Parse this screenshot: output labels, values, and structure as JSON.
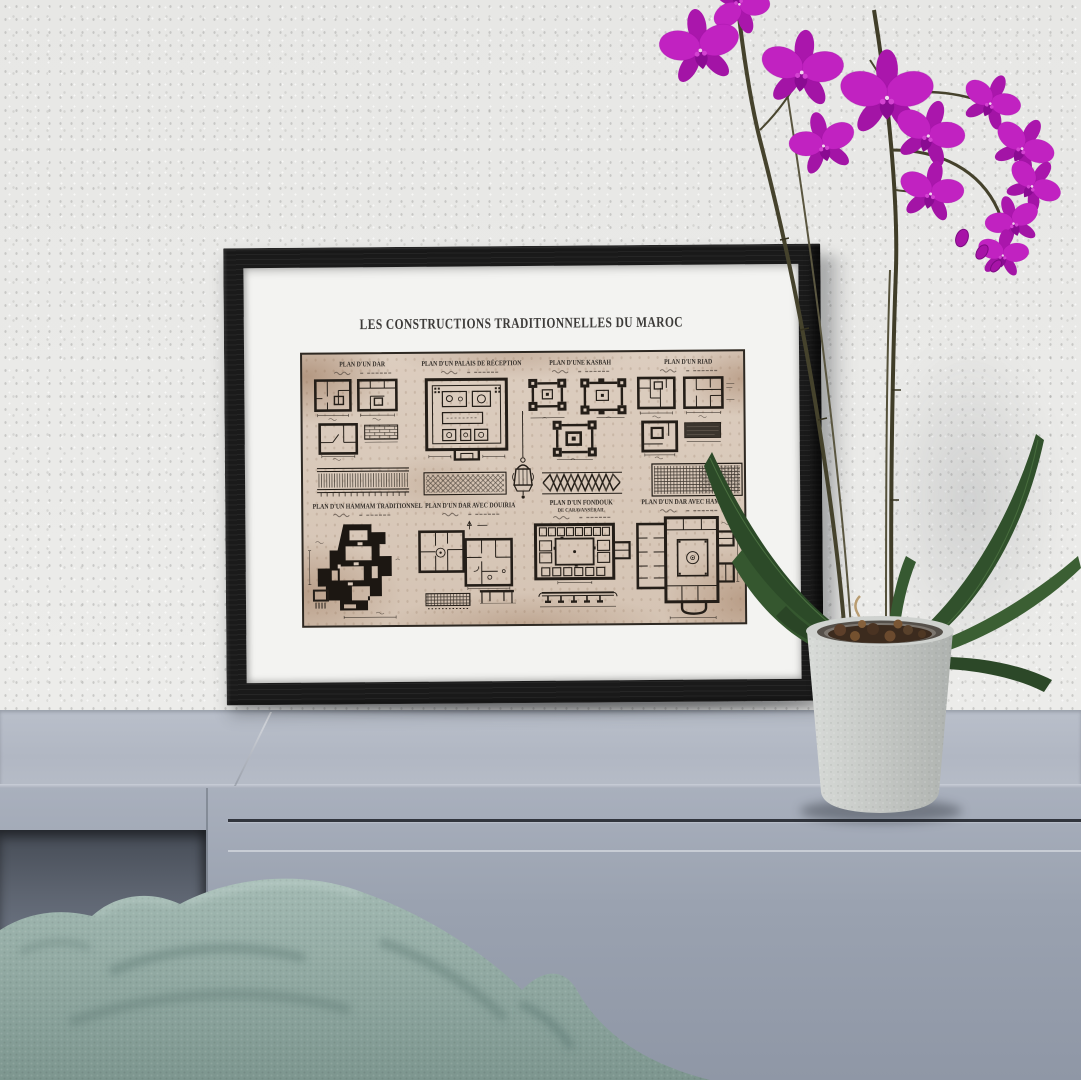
{
  "poster": {
    "title": "LES CONSTRUCTIONS TRADITIONNELLES DU MAROC",
    "plans": [
      {
        "title": "PLAN D'UN DAR"
      },
      {
        "title": "PLAN D'UN PALAIS DE RÉCEPTION"
      },
      {
        "title": "PLAN D'UNE KASBAH"
      },
      {
        "title": "PLAN D'UN RIAD"
      },
      {
        "title": "PLAN D'UN HAMMAM TRADITIONNEL"
      },
      {
        "title": "PLAN D'UN DAR AVEC DOUIRIA"
      },
      {
        "title": "PLAN D'UN FONDOUK",
        "subtitle": "DE CARAVANSÉRAIL"
      },
      {
        "title": "PLAN D'UN DAR AVEC HAMMAM"
      }
    ]
  },
  "scene": {
    "colors": {
      "wall": "#e9e9e7",
      "frame": "#1a1a1a",
      "mat": "#f3f3f1",
      "poster_paper": "#d9c9ba",
      "stain_brown": "#b08d71",
      "ink": "#241e18",
      "sideboard_top": "#b4bac6",
      "sideboard_front": "#9da5b2",
      "recess_shadow": "#565d68",
      "cushion_teal": "#8aa39e",
      "pot_gray": "#cbcecb",
      "bark_brown": "#44301f",
      "leaf_green": "#31512c",
      "stem_olive": "#45422c",
      "orchid_magenta": "#bd1ebc",
      "orchid_lip": "#8a0b92"
    }
  }
}
